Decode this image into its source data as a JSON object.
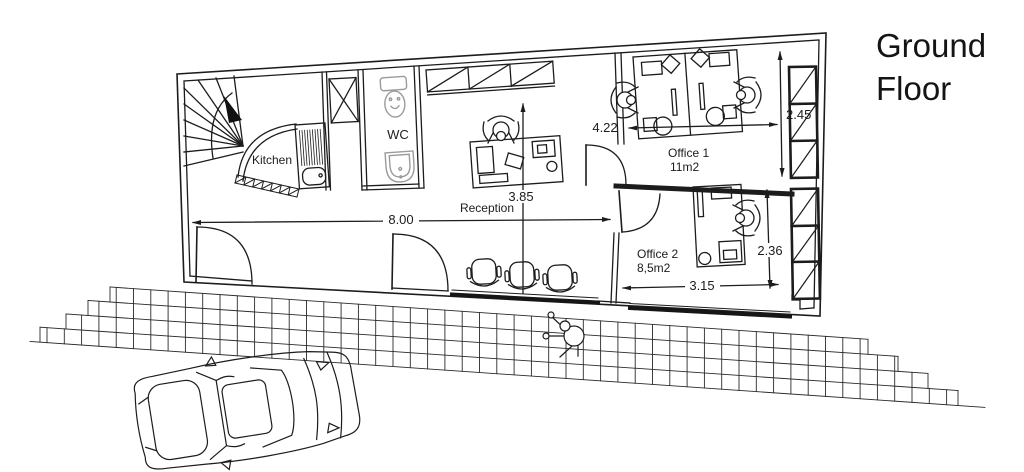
{
  "title": {
    "line1": "Ground",
    "line2": "Floor"
  },
  "plan": {
    "rooms": {
      "kitchen": {
        "label": "Kitchen"
      },
      "wc": {
        "label": "WC"
      },
      "reception": {
        "label": "Reception"
      },
      "office1": {
        "label": "Office 1",
        "area": "11m2"
      },
      "office2": {
        "label": "Office 2",
        "area": "8,5m2"
      }
    },
    "dimensions": {
      "hall_width": "8.00",
      "reception_depth": "3.85",
      "office1_width": "4.22",
      "office1_depth": "2.45",
      "office2_width": "3.15",
      "office2_depth": "2.36"
    }
  },
  "colors": {
    "line": "#1c1c1c",
    "fixture_gray": "#9b9b9b",
    "paper": "#ffffff"
  }
}
